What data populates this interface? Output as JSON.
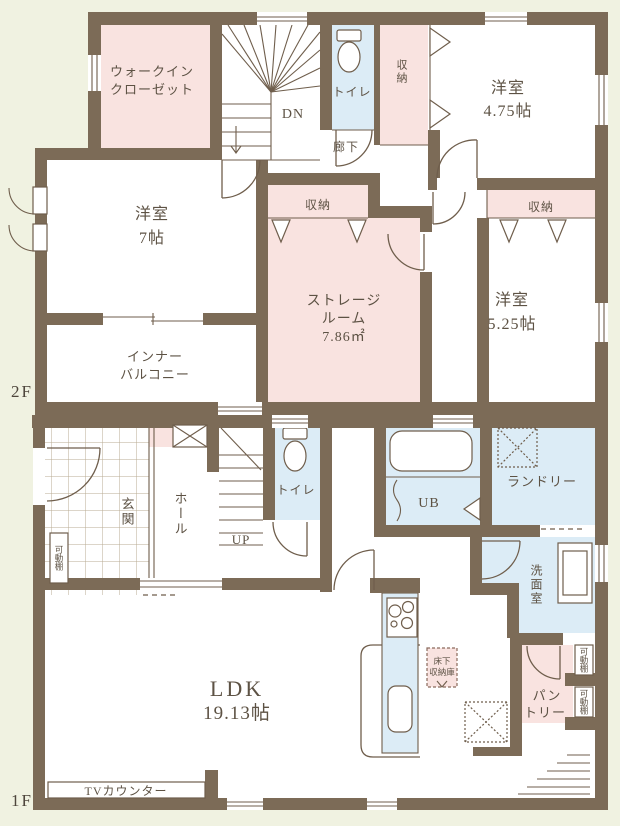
{
  "plan_title": "間取り図",
  "colors": {
    "background": "#f0f2e1",
    "wall": "#7c6b57",
    "room_pink": "#f9e3e0",
    "room_blue": "#dcecf6",
    "room_white": "#ffffff",
    "line": "#6f5e4c",
    "text": "#5d5244"
  },
  "floor2": {
    "floor_label": "2F",
    "walk_in_closet": {
      "line1": "ウォークイン",
      "line2": "クローゼット"
    },
    "stairs_down_label": "DN",
    "toilet_label": "トイレ",
    "closet_top_label": "収納",
    "room_475": {
      "line1": "洋室",
      "line2": "4.75帖"
    },
    "hallway_label": "廊下",
    "room_7": {
      "line1": "洋室",
      "line2": "7帖"
    },
    "closet_center_label": "収納",
    "closet_right_label": "収納",
    "storage_room": {
      "line1": "ストレージ",
      "line2": "ルーム",
      "line3": "7.86㎡"
    },
    "room_525": {
      "line1": "洋室",
      "line2": "5.25帖"
    },
    "inner_balcony": {
      "line1": "インナー",
      "line2": "バルコニー"
    }
  },
  "floor1": {
    "floor_label": "1F",
    "entrance_label": "玄関",
    "hall_label": "ホール",
    "stairs_up_label": "UP",
    "movable_shelf_left": "可動棚",
    "toilet_label": "トイレ",
    "unit_bath_label": "UB",
    "laundry_label": "ランドリー",
    "washroom_label": "洗面室",
    "ldk": {
      "line1": "LDK",
      "line2": "19.13帖"
    },
    "underfloor_storage": {
      "line1": "床下",
      "line2": "収納庫"
    },
    "pantry": {
      "line1": "パン",
      "line2": "トリー"
    },
    "movable_shelf_top": "可動棚",
    "movable_shelf_bottom": "可動棚",
    "tv_counter_label": "TVカウンター"
  }
}
